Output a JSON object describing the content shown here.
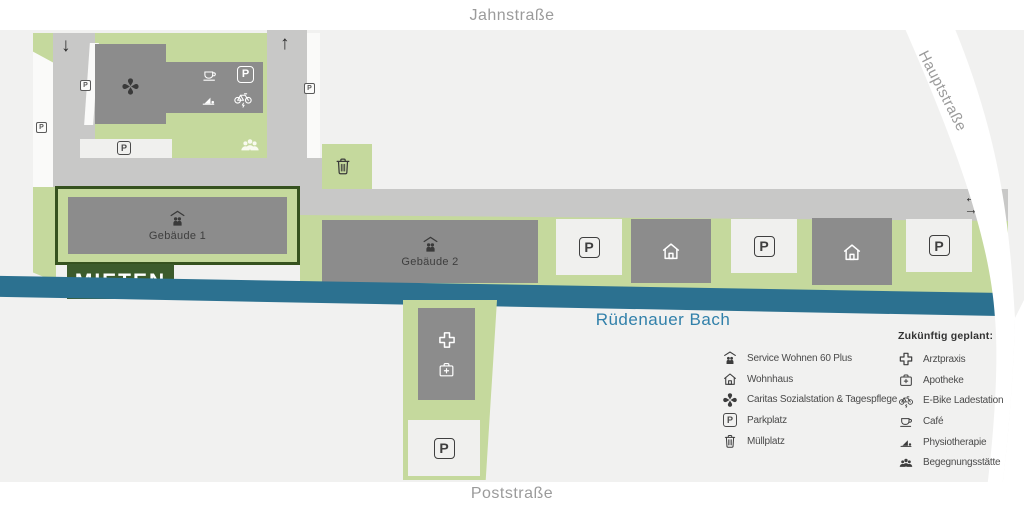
{
  "streets": {
    "jahnstrasse": "Jahnstraße",
    "hauptstrasse": "Hauptstraße",
    "poststrasse": "Poststraße"
  },
  "water": {
    "name": "Rüdenauer Bach"
  },
  "map": {
    "gebaeude1": "Gebäude 1",
    "gebaeude2": "Gebäude 2",
    "mieten_badge": "MIETEN",
    "parking": "P",
    "arrow_down": "↓",
    "arrow_up": "↑",
    "arrow_left": "←",
    "arrow_right": "→"
  },
  "legend_existing": {
    "items": [
      {
        "icon": "service-wohnen-icon",
        "label": "Service Wohnen 60 Plus"
      },
      {
        "icon": "wohnhaus-icon",
        "label": "Wohnhaus"
      },
      {
        "icon": "caritas-icon",
        "label": "Caritas Sozialstation & Tagespflege"
      },
      {
        "icon": "parkplatz-icon",
        "label": "Parkplatz"
      },
      {
        "icon": "muellplatz-icon",
        "label": "Müllplatz"
      }
    ]
  },
  "legend_planned": {
    "title": "Zukünftig geplant:",
    "items": [
      {
        "icon": "arztpraxis-icon",
        "label": "Arztpraxis"
      },
      {
        "icon": "apotheke-icon",
        "label": "Apotheke"
      },
      {
        "icon": "ebike-icon",
        "label": "E-Bike Ladestation"
      },
      {
        "icon": "cafe-icon",
        "label": "Café"
      },
      {
        "icon": "physiotherapie-icon",
        "label": "Physiotherapie"
      },
      {
        "icon": "begegnungsstaette-icon",
        "label": "Begegnungsstätte"
      }
    ]
  },
  "colors": {
    "green_area": "#c5d99d",
    "building": "#8c8c8c",
    "road": "#c8c8c7",
    "parking_lot": "#f0f0ee",
    "map_background": "#f1f1f0",
    "stream": "#2c7190",
    "stream_label": "#3180aa",
    "highlight_green": "#3c5b2c",
    "highlight_border": "#36521f",
    "street_label": "#9b9b9b",
    "legend_text": "#4a4a4a"
  }
}
